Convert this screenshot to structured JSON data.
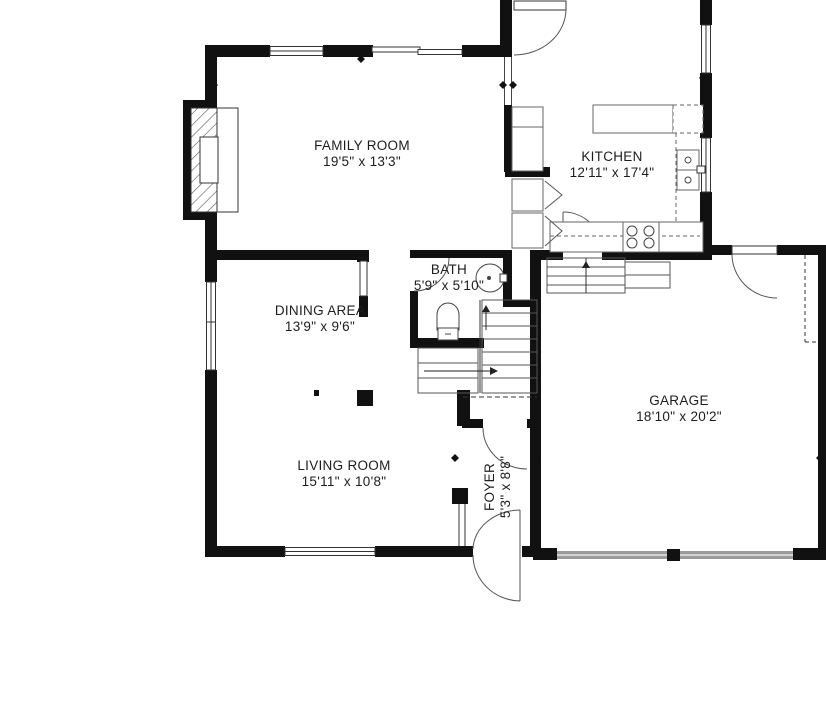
{
  "title": "Floor plan",
  "rooms": [
    {
      "name": "FAMILY ROOM",
      "dims": "19'5\" x 13'3\""
    },
    {
      "name": "KITCHEN",
      "dims": "12'11\" x 17'4\""
    },
    {
      "name": "DINING AREA",
      "dims": "13'9\" x 9'6\""
    },
    {
      "name": "BATH",
      "dims": "5'9\" x 5'10\""
    },
    {
      "name": "GARAGE",
      "dims": "18'10\" x 20'2\""
    },
    {
      "name": "LIVING ROOM",
      "dims": "15'11\" x 10'8\""
    },
    {
      "name": "FOYER",
      "dims": "5'3\" x 8'8\""
    }
  ],
  "colors": {
    "wall": "#111111",
    "background": "#ffffff",
    "text": "#1d1d1d",
    "garage_door": "#9b9b9b",
    "thin_line": "#4a4a4a"
  }
}
